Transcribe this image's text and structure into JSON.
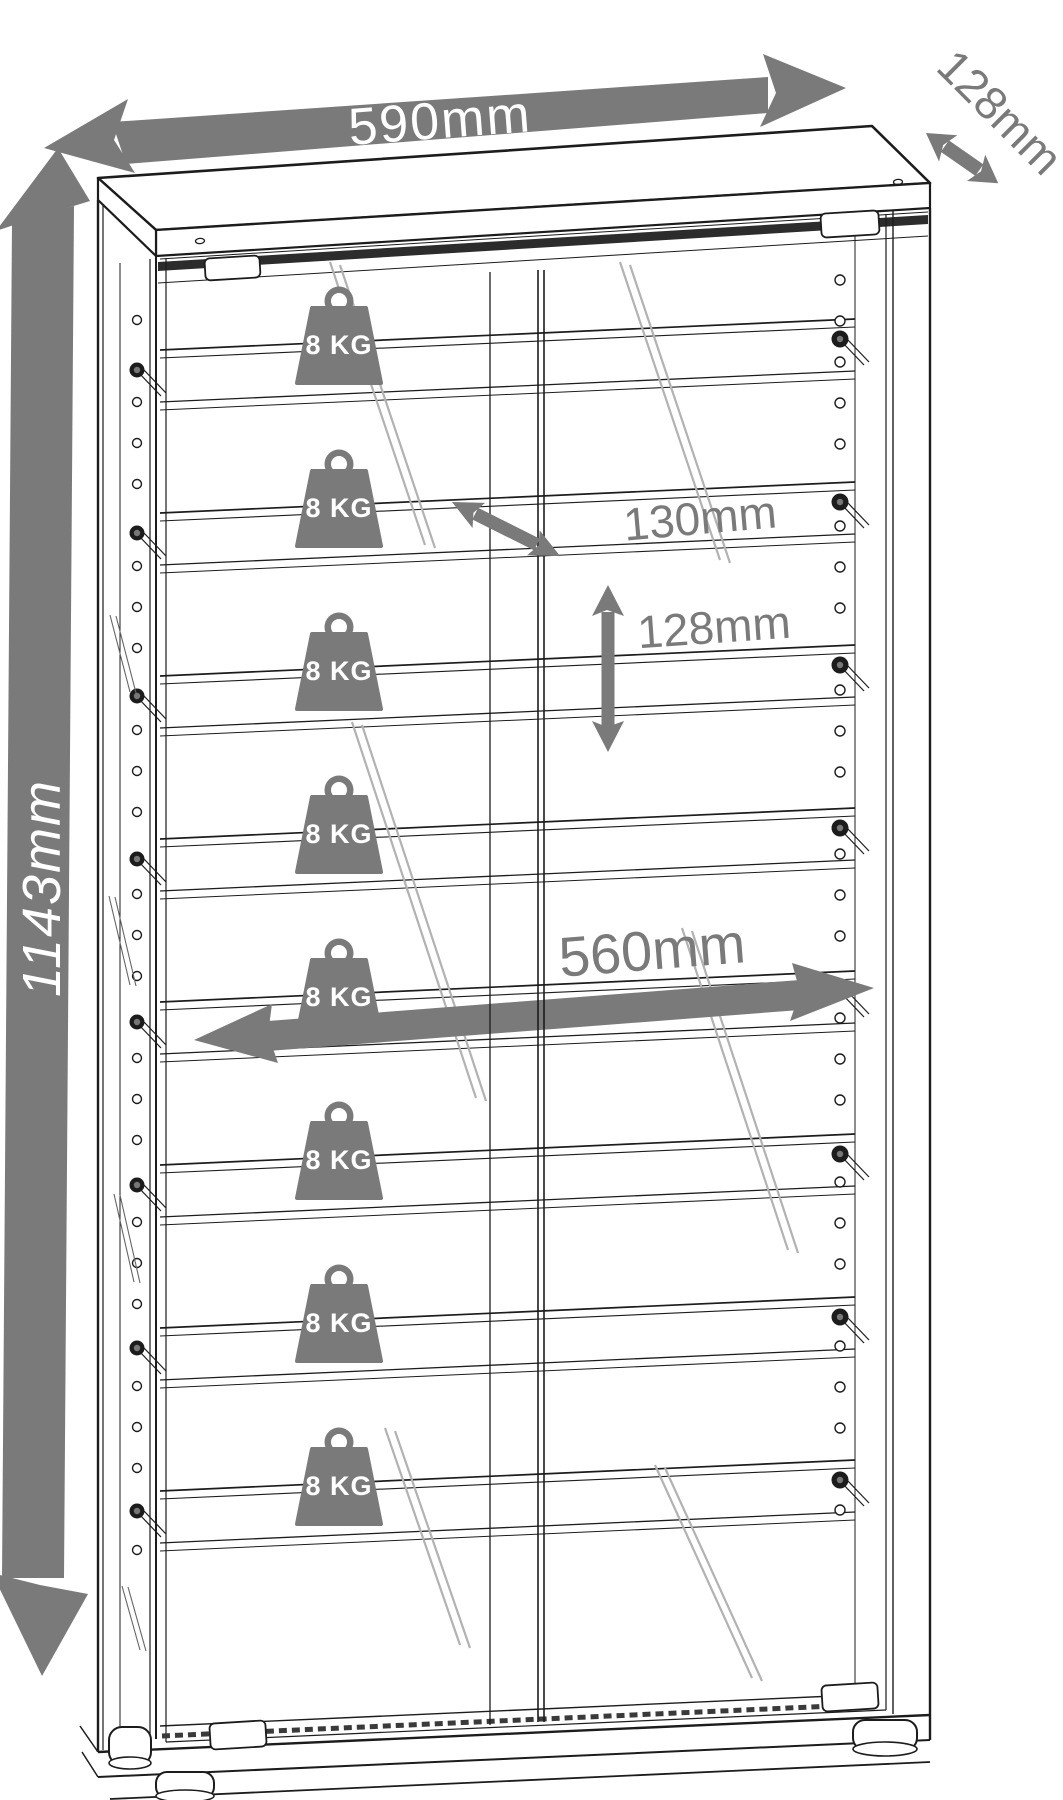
{
  "page": {
    "background": "#ffffff"
  },
  "diagram": {
    "type": "furniture dimension line drawing",
    "subject": "glass display cabinet with shelves",
    "colors": {
      "annotation_gray": "#7a7a7a",
      "line": "#1c1c1c",
      "band_label_text": "#ffffff",
      "glass_shine": "#b2b2b2"
    },
    "dimensions": {
      "overall_width": {
        "label": "590mm"
      },
      "overall_depth": {
        "label": "128mm"
      },
      "overall_height": {
        "label": "1143mm"
      },
      "shelf_depth": {
        "label": "130mm"
      },
      "shelf_spacing": {
        "label": "128mm"
      },
      "inner_width": {
        "label": "560mm"
      }
    },
    "shelves": {
      "count": 8,
      "load_capacity_label": "8 KG"
    }
  }
}
